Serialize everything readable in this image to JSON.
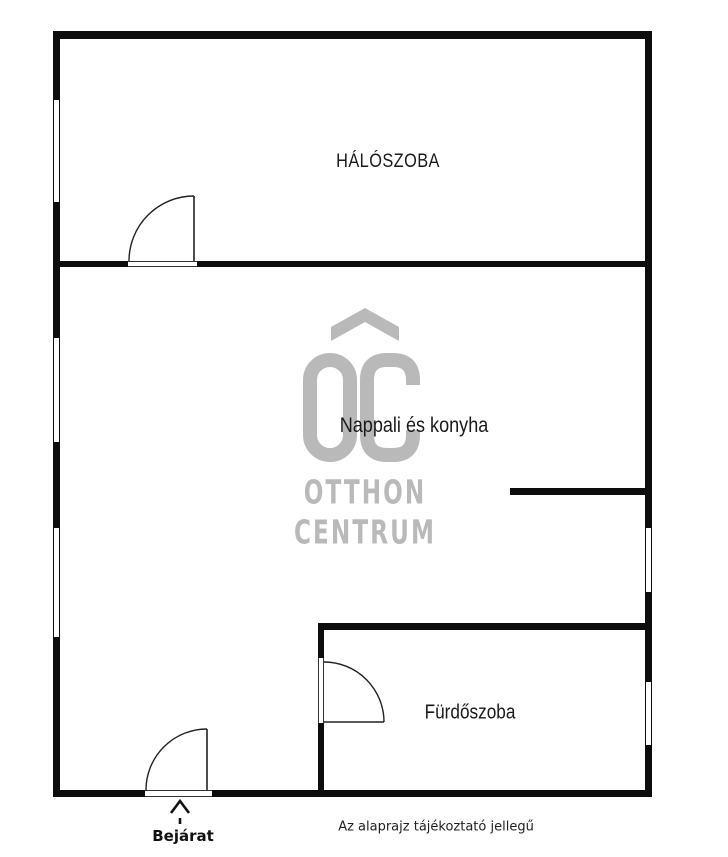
{
  "plan": {
    "rooms": [
      {
        "id": "bedroom",
        "label": "HÁLÓSZOBA"
      },
      {
        "id": "living-kitchen",
        "label": "Nappali és konyha"
      },
      {
        "id": "bathroom",
        "label": "Fürdőszoba"
      }
    ],
    "entrance_label": "Bejárat",
    "disclaimer": "Az alaprajz tájékoztató jellegű",
    "features": {
      "doors": [
        "bedroom-door",
        "entrance-door",
        "bathroom-door"
      ],
      "windows_left": 3,
      "windows_right": 2
    }
  },
  "watermark": {
    "monogram": "OC",
    "line1": "OTTHON",
    "line2": "CENTRUM",
    "color": "#b9b9b9"
  },
  "colors": {
    "wall": "#0d0d0d",
    "text": "#1a1a1a",
    "background": "#ffffff"
  }
}
